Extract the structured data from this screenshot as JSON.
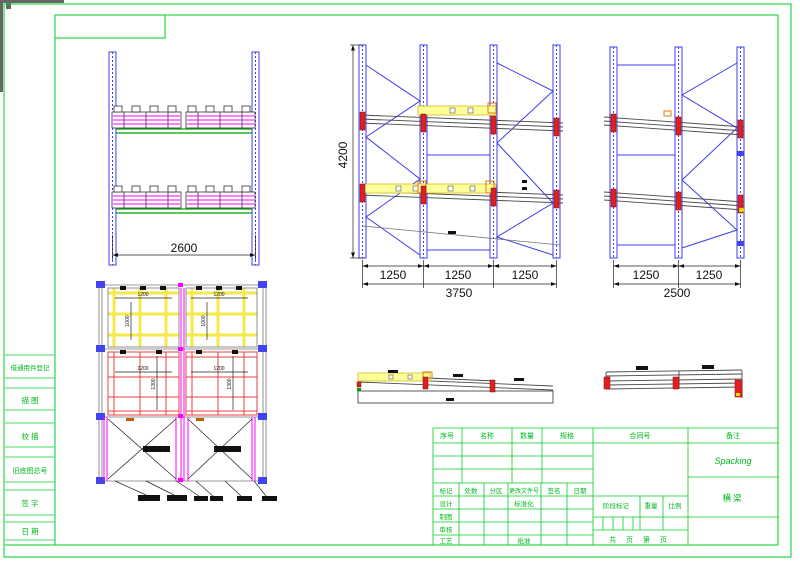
{
  "drawing": {
    "front_view": {
      "width_dim": "2600"
    },
    "side_view": {
      "height_dim": "4200",
      "bay_dims": [
        "1250",
        "1250",
        "1250"
      ],
      "total_dim": "3750"
    },
    "end_view": {
      "bay_dims": [
        "1250",
        "1250"
      ],
      "total_dim": "2500"
    },
    "plan_view": {
      "top_pallet_width": "1200",
      "top_pallet_depth": "1000",
      "mid_pallet_width": "1200",
      "mid_pallet_depth": "1300"
    }
  },
  "margin_strip": {
    "items": [
      "借通用件登记",
      "描 图",
      "校 描",
      "旧底图总号",
      "签 字",
      "日 期"
    ]
  },
  "title_block": {
    "parts_header": [
      "序号",
      "名称",
      "数量",
      "规格",
      "合同号",
      "备注"
    ],
    "revision_header": [
      "标记",
      "处数",
      "分区",
      "更改文件号",
      "签名",
      "日期"
    ],
    "roles": [
      "设计",
      "制图",
      "审核",
      "工艺"
    ],
    "standardize_label": "标准化",
    "approve_label": "批准",
    "stage_label": "阶段标记",
    "weight_label": "重量",
    "scale_label": "比例",
    "pages_label": "共 页 第 页",
    "project_name": "Spacking",
    "drawing_title": "横梁"
  },
  "colors": {
    "frame_green": "#00cf22",
    "upright_blue": "#3c3cf0",
    "pallet_magenta": "#ff00ff",
    "beam_yellow": "#ffff9a",
    "connector_red": "#e02020"
  }
}
